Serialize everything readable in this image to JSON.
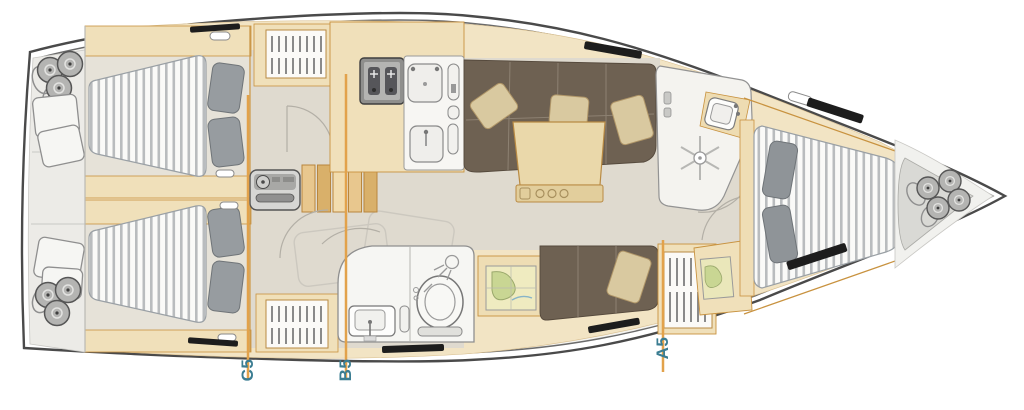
{
  "page": {
    "title": "sailing-yacht-interior-floor-plan"
  },
  "section_labels": [
    {
      "id": "c5",
      "label": "C5"
    },
    {
      "id": "b5",
      "label": "B5"
    },
    {
      "id": "a5",
      "label": "A5"
    }
  ],
  "colors": {
    "section_line": "#E2A24B",
    "label_text": "#3B7D92",
    "hull_outline": "#4A4A4A",
    "deck": "#F4F3EF",
    "wood_light": "#F2E4C4",
    "wood_mid": "#F0E0BA",
    "wood_trim": "#C8923F",
    "floor": "#DFDACF",
    "upholstery_brown": "#6E6152",
    "cushion_beige": "#D9C9A0",
    "mattress_white": "#FAFAF8",
    "mattress_stripe": "#B9BCBE",
    "pillow_gray": "#979CA0",
    "hatch_black": "#1D1D1D"
  },
  "rooms": {
    "aft_cabin_port": "aft double cabin port",
    "aft_cabin_starboard": "aft double cabin starboard",
    "saloon": "saloon sofa and table",
    "galley": "galley with stove and sinks",
    "aft_head": "aft head with toilet and sink",
    "forward_head": "forward shower room",
    "forward_cabin": "forward double cabin",
    "companionway": "companionway steps and engine box",
    "nav_station": "chart table",
    "bow_locker": "bow fender locker",
    "stern_locker": "stern fenders and cushions"
  },
  "icons": [
    "shower-drain-icon",
    "shower-head-icon",
    "toilet-icon",
    "sink-icon",
    "stove-burners-icon",
    "fender-icon",
    "cushion-icon",
    "pillow-icon",
    "louver-vent-icon",
    "stairs-icon",
    "chart-map-icon",
    "engine-icon",
    "bottle-holder-icon"
  ]
}
